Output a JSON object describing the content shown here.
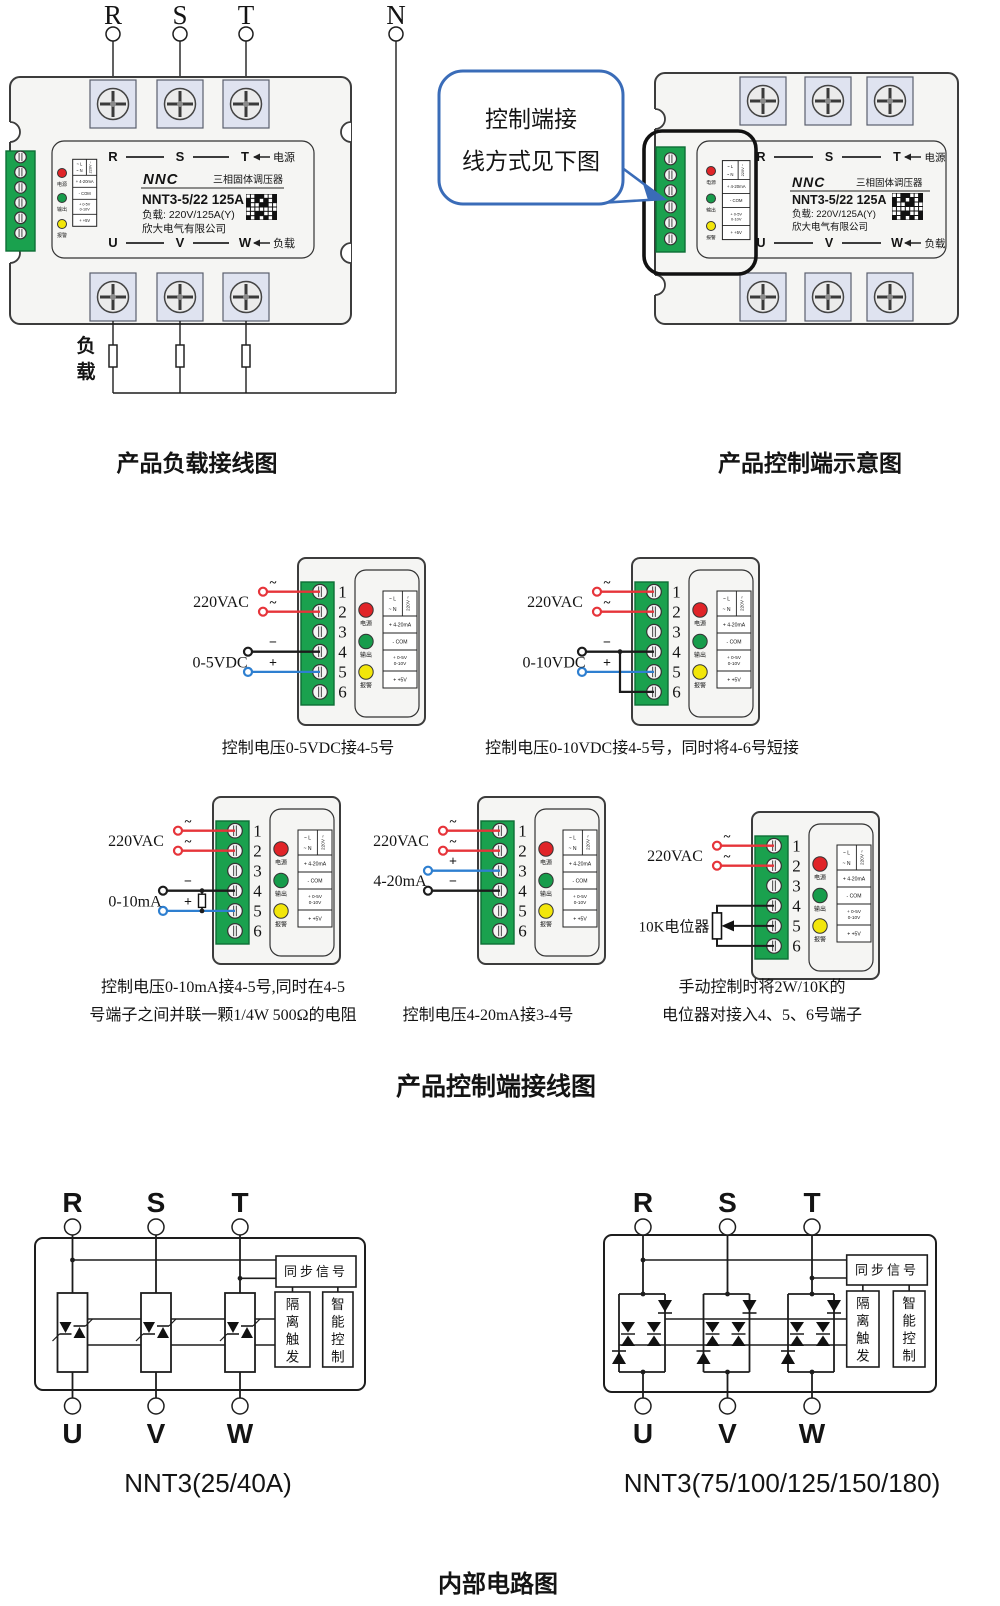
{
  "colors": {
    "line": "#1d1d1d",
    "body_fill": "#f5f5f3",
    "body_stroke": "#3c3c3c",
    "pad_fill": "#dfe3f0",
    "screw_fill": "#ebebeb",
    "green_fill": "#1aa14e",
    "green_stroke": "#0d6e35",
    "led_red": "#e02428",
    "led_green": "#179c4b",
    "led_yellow": "#f2e60a",
    "wire_red": "#e6343a",
    "wire_blue": "#2e7fd0",
    "wire_black": "#1c1c1c",
    "bubble_stroke": "#3a6cb8",
    "highlight_stroke": "#111111"
  },
  "figures": {
    "load": {
      "caption": "产品负载接线图",
      "phases": [
        "R",
        "S",
        "T"
      ],
      "neutral": "N",
      "load_label": "负载"
    },
    "overview": {
      "caption": "产品控制端示意图",
      "bubble": [
        "控制端接",
        "线方式见下图"
      ]
    },
    "panel": {
      "brand": "NNC",
      "subtitle": "三相固体调压器",
      "model": "NNT3-5/22 125A",
      "load_spec": "负载: 220V/125A(Y)",
      "company": "欣大电气有限公司",
      "top_row": [
        "R",
        "S",
        "T"
      ],
      "top_right": "电源",
      "bottom_row": [
        "U",
        "V",
        "W"
      ],
      "bottom_right": "负载",
      "leds": [
        "电源",
        "输出",
        "报警"
      ],
      "legend_l": "~ L",
      "legend_n": "~ N",
      "legend_v": "220V ~",
      "legend_rows": [
        "+ 4-20mA",
        "- COM",
        "+ 0-5V|0-10V",
        "+ +5V"
      ]
    },
    "controls": {
      "title": "产品控制端接线图",
      "numbers": [
        "1",
        "2",
        "3",
        "4",
        "5",
        "6"
      ],
      "symbols": {
        "ac": "~",
        "plus": "+",
        "minus": "−"
      },
      "diagrams": [
        {
          "ac_label": "220VAC",
          "sig_label": "0-5VDC",
          "caption": [
            "控制电压0-5VDC接4-5号"
          ],
          "wires": [
            {
              "terminal": 1,
              "color": "red",
              "symbol": "~"
            },
            {
              "terminal": 2,
              "color": "red",
              "symbol": "~"
            },
            {
              "terminal": 4,
              "color": "black",
              "symbol": "−"
            },
            {
              "terminal": 5,
              "color": "blue",
              "symbol": "+"
            }
          ]
        },
        {
          "ac_label": "220VAC",
          "sig_label": "0-10VDC",
          "caption": [
            "控制电压0-10VDC接4-5号，同时将4-6号短接"
          ],
          "wires": [
            {
              "terminal": 1,
              "color": "red",
              "symbol": "~"
            },
            {
              "terminal": 2,
              "color": "red",
              "symbol": "~"
            },
            {
              "terminal": 4,
              "color": "black",
              "symbol": "−"
            },
            {
              "terminal": 5,
              "color": "blue",
              "symbol": "+"
            }
          ],
          "jumper": [
            4,
            6
          ]
        },
        {
          "ac_label": "220VAC",
          "sig_label": "0-10mA",
          "caption": [
            "控制电压0-10mA接4-5号,同时在4-5",
            "号端子之间并联一颗1/4W 500Ω的电阻"
          ],
          "wires": [
            {
              "terminal": 1,
              "color": "red",
              "symbol": "~"
            },
            {
              "terminal": 2,
              "color": "red",
              "symbol": "~"
            },
            {
              "terminal": 4,
              "color": "black",
              "symbol": "−"
            },
            {
              "terminal": 5,
              "color": "blue",
              "symbol": "+"
            }
          ],
          "resistor": [
            4,
            5
          ]
        },
        {
          "ac_label": "220VAC",
          "sig_label": "4-20mA",
          "caption": [
            "控制电压4-20mA接3-4号"
          ],
          "wires": [
            {
              "terminal": 1,
              "color": "red",
              "symbol": "~"
            },
            {
              "terminal": 2,
              "color": "red",
              "symbol": "~"
            },
            {
              "terminal": 3,
              "color": "blue",
              "symbol": "+"
            },
            {
              "terminal": 4,
              "color": "black",
              "symbol": "−"
            }
          ]
        },
        {
          "ac_label": "220VAC",
          "sig_label": "10K电位器",
          "caption": [
            "手动控制时将2W/10K的",
            "电位器对接入4、5、6号端子"
          ],
          "wires": [
            {
              "terminal": 1,
              "color": "red",
              "symbol": "~"
            },
            {
              "terminal": 2,
              "color": "red",
              "symbol": "~"
            }
          ],
          "pot": {
            "ends": [
              4,
              6
            ],
            "wiper": 5
          }
        }
      ]
    },
    "internal": {
      "title": "内部电路图",
      "blocks": {
        "sync": "同步信号",
        "trigger": "隔离触发",
        "control": "智能控制"
      },
      "inputs": [
        "R",
        "S",
        "T"
      ],
      "outputs": [
        "U",
        "V",
        "W"
      ],
      "left_caption": "NNT3(25/40A)",
      "right_caption": "NNT3(75/100/125/150/180)"
    }
  }
}
